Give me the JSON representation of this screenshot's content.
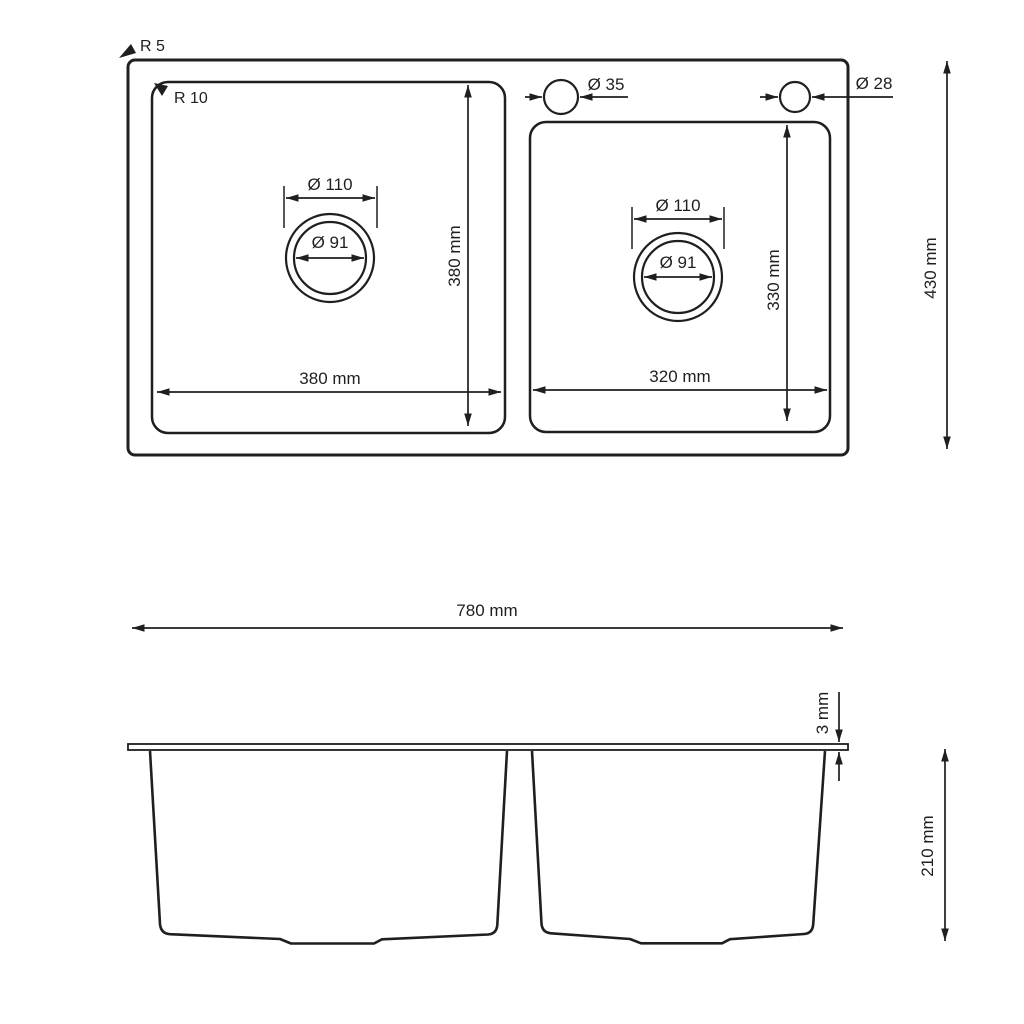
{
  "drawing": {
    "type": "kitchen-sink-technical-drawing",
    "top_view": {
      "outer_corner_radius": "R 5",
      "bowl_corner_radius": "R 10",
      "faucet_hole_diameter": "Ø 35",
      "accessory_hole_diameter": "Ø 28",
      "left_bowl": {
        "drain_flange_diameter": "Ø 110",
        "drain_diameter": "Ø 91",
        "width": "380 mm",
        "depth": "380 mm"
      },
      "right_bowl": {
        "drain_flange_diameter": "Ø 110",
        "drain_diameter": "Ø 91",
        "width": "320 mm",
        "depth": "330 mm"
      },
      "overall_depth": "430 mm"
    },
    "side_view": {
      "overall_width": "780 mm",
      "rim_thickness": "3 mm",
      "bowl_height": "210 mm"
    },
    "colors": {
      "line": "#1f1f1f",
      "background": "#ffffff"
    }
  }
}
